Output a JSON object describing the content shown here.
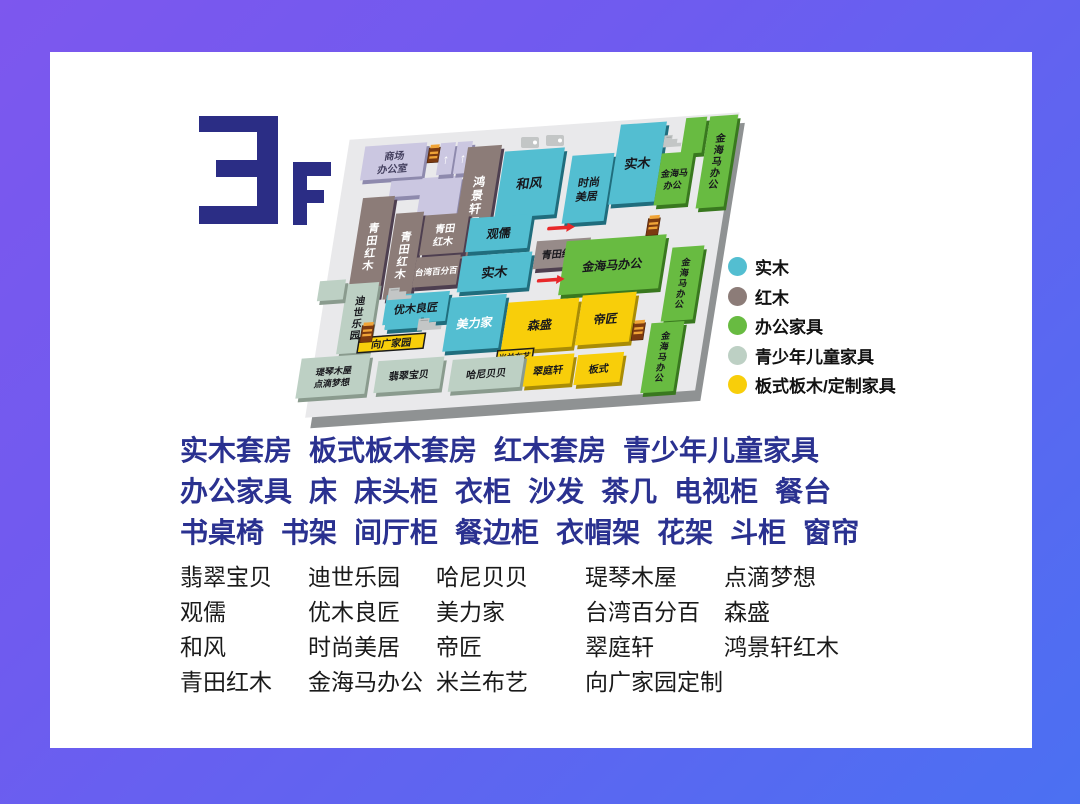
{
  "floor": {
    "number": "3",
    "suffix": "F"
  },
  "colors": {
    "frame_start": "#7d57ee",
    "frame_end": "#4b70f2",
    "logo": "#2b2d85",
    "headline": "#2a3190",
    "brand_text": "#1a1a1a",
    "plate": "#e9e9eb",
    "plate_shadow": "#8f9293",
    "red_arrow": "#e8282a",
    "gold_icon_body": "#7c3a10",
    "gold_icon_stripe": "#f0a437",
    "gray_icon": "#c3c6c6",
    "text_dark": "#17171c",
    "text_white": "#ffffff",
    "text_lavender": "#44405f"
  },
  "palette": {
    "solid_wood": "#53bed1",
    "solid_wood_dark": "#206d7d",
    "rosewood": "#8c7c78",
    "rosewood_dark": "#4e3f50",
    "rosewood_light": "#978b89",
    "rosewood_light_dark": "#4e3f50",
    "office": "#68bb41",
    "office_dark": "#39781f",
    "children": "#bdd0c4",
    "children_dark": "#8a9b8e",
    "panel": "#f8ce0a",
    "panel_dark": "#a98c06",
    "lavender": "#cbc7e1",
    "lavender_dark": "#8e8aad"
  },
  "legend": {
    "items": [
      {
        "id": "solid_wood",
        "label": "实木"
      },
      {
        "id": "rosewood",
        "label": "红木"
      },
      {
        "id": "office",
        "label": "办公家具"
      },
      {
        "id": "children",
        "label": "青少年儿童家具"
      },
      {
        "id": "panel",
        "label": "板式板木/定制家具"
      }
    ]
  },
  "map": {
    "blocks": [
      {
        "id": "shangchang",
        "lines": [
          "商场",
          "办公室"
        ],
        "category": "lavender",
        "text": "lavender"
      },
      {
        "id": "hall-step",
        "label": "",
        "category": "lavender"
      },
      {
        "id": "hall",
        "label": "",
        "category": "lavender"
      },
      {
        "id": "elevator-1",
        "label": "",
        "category": "lavender",
        "glyph": "↑"
      },
      {
        "id": "elevator-2",
        "label": "",
        "category": "lavender",
        "glyph": "↑"
      },
      {
        "id": "hongjingxuan",
        "label": "鸿景轩红木",
        "category": "rosewood",
        "text": "white",
        "vertical": true
      },
      {
        "id": "hefeng",
        "label": "和风",
        "category": "solid_wood",
        "text": "dark"
      },
      {
        "id": "shishang",
        "lines": [
          "时尚",
          "美居"
        ],
        "category": "solid_wood",
        "text": "dark"
      },
      {
        "id": "shimu-top",
        "label": "实木",
        "category": "solid_wood",
        "text": "dark"
      },
      {
        "id": "jinhaima-arm",
        "label": "",
        "category": "office"
      },
      {
        "id": "jinhaima-small",
        "lines": [
          "金海马",
          "办公"
        ],
        "category": "office",
        "text": "dark"
      },
      {
        "id": "jinhaima-v1",
        "label": "金海马办公",
        "category": "office",
        "text": "dark",
        "vertical": true
      },
      {
        "id": "qingtian-l1",
        "label": "青田红木",
        "category": "rosewood",
        "text": "white",
        "vertical": true
      },
      {
        "id": "qingtian-l2",
        "label": "青田红木",
        "category": "rosewood",
        "text": "white",
        "vertical": true
      },
      {
        "id": "qingtian-2line",
        "lines": [
          "青田",
          "红木"
        ],
        "category": "rosewood",
        "text": "white"
      },
      {
        "id": "guanru",
        "label": "观儒",
        "category": "solid_wood",
        "text": "dark"
      },
      {
        "id": "taiwan",
        "label": "台湾百分百",
        "category": "rosewood",
        "text": "white"
      },
      {
        "id": "shimu-mid",
        "label": "实木",
        "category": "solid_wood",
        "text": "dark"
      },
      {
        "id": "qingtian-mid",
        "label": "青田红木",
        "category": "rosewood_light",
        "text": "dark"
      },
      {
        "id": "jinhaima-big",
        "label": "金海马办公",
        "category": "office",
        "text": "dark"
      },
      {
        "id": "jinhaima-v2",
        "label": "金海马办公",
        "category": "office",
        "text": "dark",
        "vertical": true
      },
      {
        "id": "jinhaima-v3",
        "label": "金海马办公",
        "category": "office",
        "text": "dark",
        "vertical": true
      },
      {
        "id": "dishi",
        "label": "迪世乐园",
        "category": "children",
        "text": "dark",
        "vertical": true
      },
      {
        "id": "sage-square",
        "label": "",
        "category": "children"
      },
      {
        "id": "youmu",
        "label": "优木良匠",
        "category": "solid_wood",
        "text": "dark"
      },
      {
        "id": "youmu-step",
        "label": "",
        "category": "solid_wood"
      },
      {
        "id": "meilijia",
        "label": "美力家",
        "category": "solid_wood",
        "text": "white"
      },
      {
        "id": "xiangguang",
        "label": "向广家园",
        "category": "panel",
        "text": "dark",
        "outlined": true
      },
      {
        "id": "sensheng",
        "label": "森盛",
        "category": "panel",
        "text": "dark"
      },
      {
        "id": "dijiang",
        "label": "帝匠",
        "category": "panel",
        "text": "dark"
      },
      {
        "id": "milan",
        "label": "米兰布艺",
        "category": "panel",
        "text": "dark",
        "outlined": true
      },
      {
        "id": "cuiting",
        "label": "翠庭轩",
        "category": "panel",
        "text": "dark"
      },
      {
        "id": "banshi",
        "label": "板式",
        "category": "panel",
        "text": "dark"
      },
      {
        "id": "qinqin",
        "lines": [
          "瑅琴木屋",
          "点滴梦想"
        ],
        "category": "children",
        "text": "dark"
      },
      {
        "id": "feicui",
        "label": "翡翠宝贝",
        "category": "children",
        "text": "dark"
      },
      {
        "id": "hani",
        "label": "哈尼贝贝",
        "category": "children",
        "text": "dark"
      }
    ],
    "icons": [
      {
        "id": "gold-a",
        "type": "cabinet"
      },
      {
        "id": "gold-b",
        "type": "cabinet"
      },
      {
        "id": "gold-c",
        "type": "cabinet"
      },
      {
        "id": "gold-d",
        "type": "cabinet"
      },
      {
        "id": "grayL-a",
        "type": "escalator"
      },
      {
        "id": "grayL-b",
        "type": "escalator"
      },
      {
        "id": "grayL-c",
        "type": "escalator"
      },
      {
        "id": "arrow-1",
        "type": "red-arrow"
      },
      {
        "id": "arrow-2",
        "type": "red-arrow"
      },
      {
        "id": "wc-a",
        "type": "restroom"
      },
      {
        "id": "wc-b",
        "type": "restroom"
      }
    ]
  },
  "category_lines": [
    [
      "实木套房",
      "板式板木套房",
      "红木套房",
      "青少年儿童家具"
    ],
    [
      "办公家具",
      "床",
      "床头柜",
      "衣柜",
      "沙发",
      "茶几",
      "电视柜",
      "餐台"
    ],
    [
      "书桌椅",
      "书架",
      "间厅柜",
      "餐边柜",
      "衣帽架",
      "花架",
      "斗柜",
      "窗帘"
    ]
  ],
  "brand_rows": [
    [
      "翡翠宝贝",
      "迪世乐园",
      "哈尼贝贝",
      "瑅琴木屋",
      "点滴梦想"
    ],
    [
      "观儒",
      "优木良匠",
      "美力家",
      "台湾百分百",
      "森盛"
    ],
    [
      "和风",
      "时尚美居",
      "帝匠",
      "翠庭轩",
      "鸿景轩红木"
    ],
    [
      "青田红木",
      "金海马办公",
      "米兰布艺",
      "向广家园定制"
    ]
  ]
}
